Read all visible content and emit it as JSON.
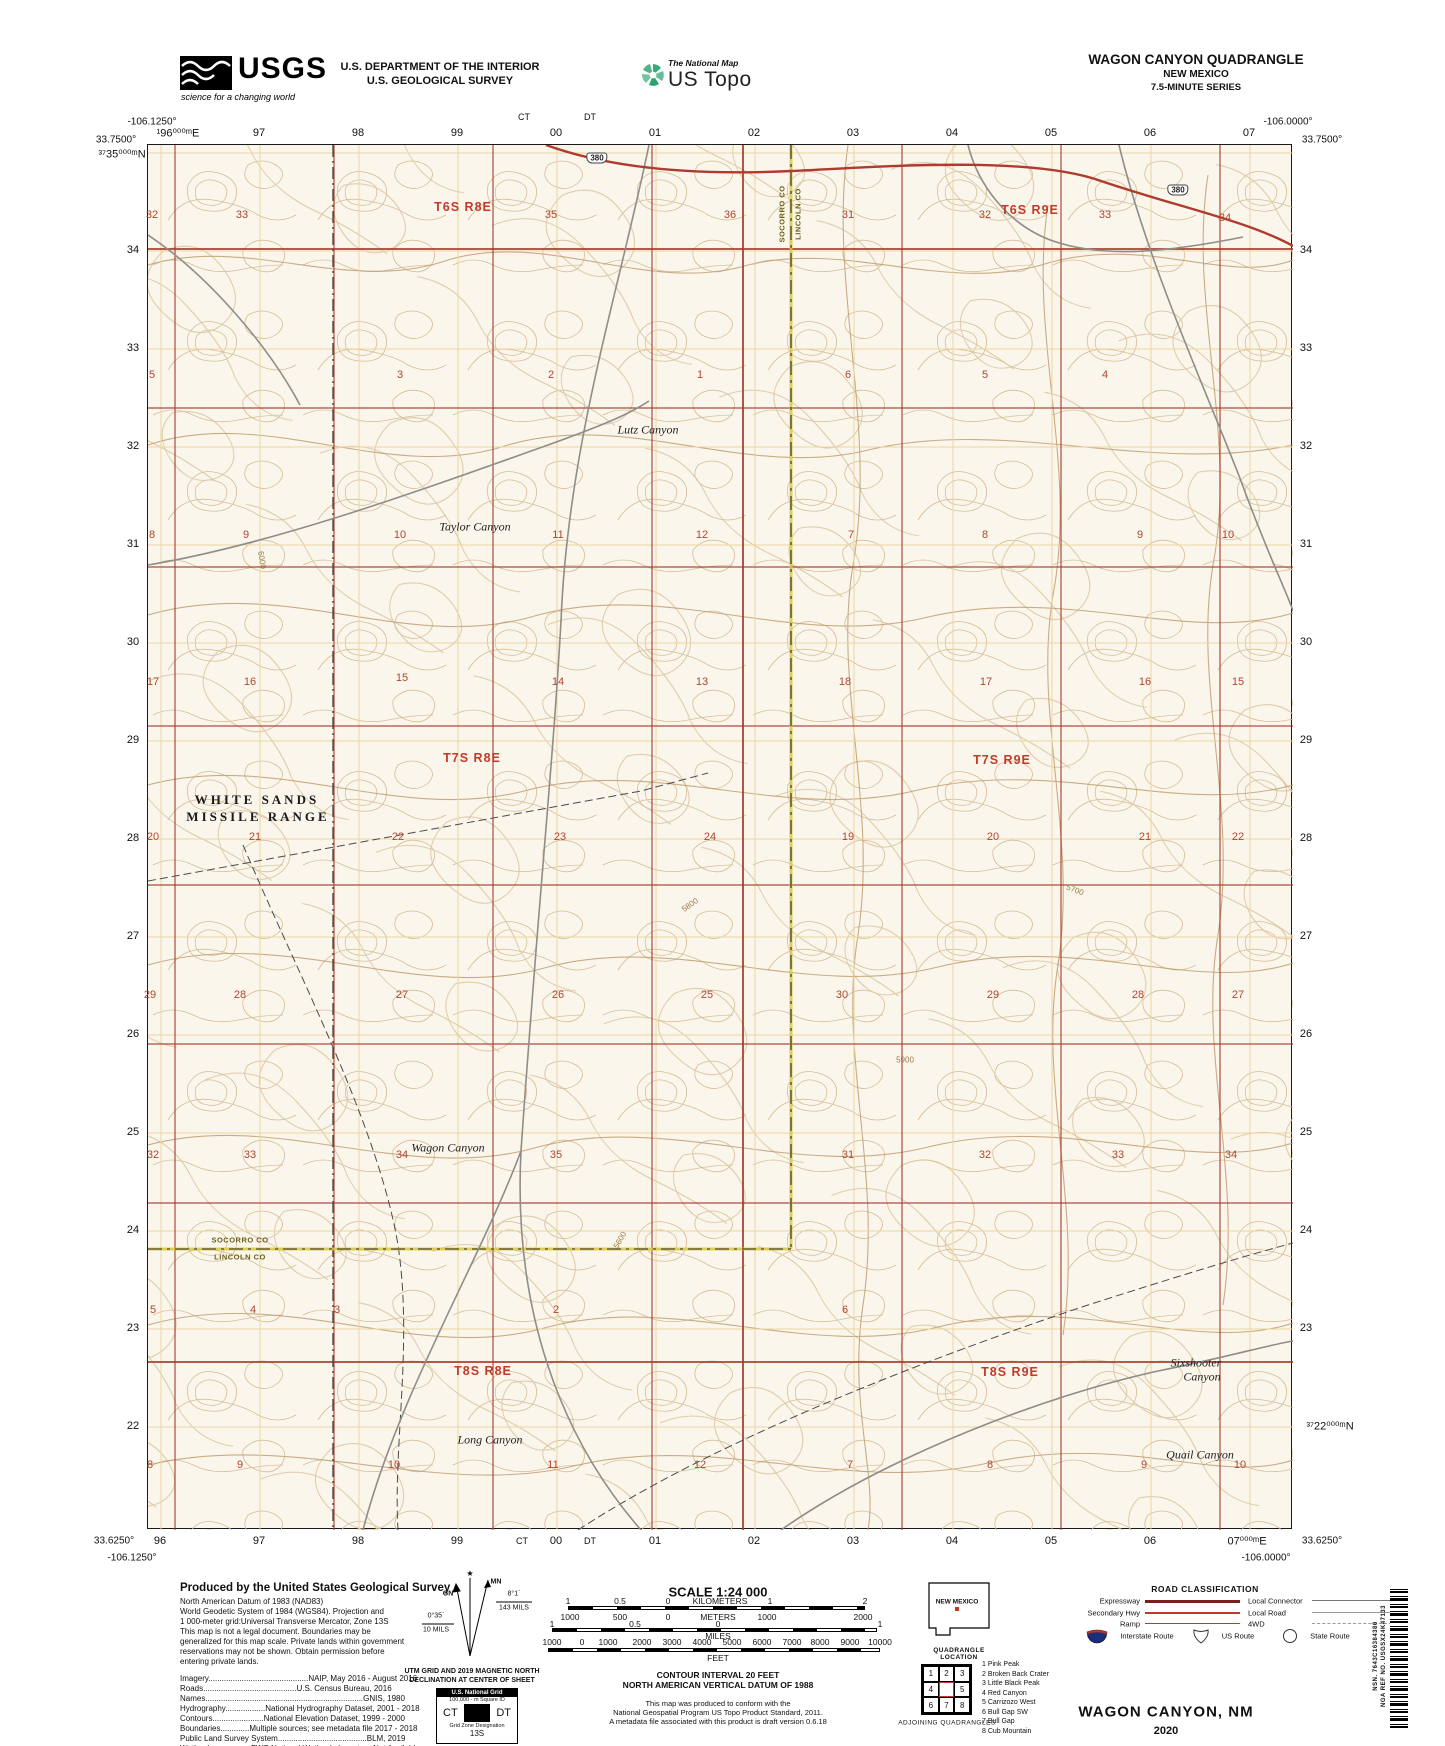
{
  "header": {
    "usgs_logo": "USGS",
    "usgs_tagline": "science for a changing world",
    "agency_line1": "U.S. DEPARTMENT OF THE INTERIOR",
    "agency_line2": "U.S. GEOLOGICAL SURVEY",
    "program_small": "The National Map",
    "program_large": "US Topo",
    "quad_title": "WAGON CANYON QUADRANGLE",
    "quad_state": "NEW MEXICO",
    "quad_series": "7.5-MINUTE SERIES"
  },
  "map": {
    "corners": {
      "tl_lon": "-106.1250°",
      "tl_lat": "33.7500°",
      "tr_lon": "-106.0000°",
      "tr_lat": "33.7500°",
      "bl_lat": "33.6250°",
      "bl_lon": "-106.1250°",
      "br_lat": "33.6250°",
      "br_lon": "-106.0000°"
    },
    "grid_cols": [
      160,
      259,
      358,
      457,
      556,
      655,
      754,
      853,
      952,
      1051,
      1150,
      1249
    ],
    "grid_rows": [
      152,
      250,
      348,
      446,
      544,
      642,
      740,
      838,
      936,
      1034,
      1132,
      1230,
      1328,
      1426
    ],
    "section_xs": [
      174,
      333,
      492,
      651,
      742,
      901,
      1060,
      1219
    ],
    "section_ys": [
      248,
      407,
      566,
      725,
      884,
      1043,
      1202,
      1361
    ],
    "top_grid": [
      {
        "t": "¹96⁰⁰⁰ᵐE",
        "x": 178,
        "y": 133
      },
      {
        "t": "97",
        "x": 259,
        "y": 133
      },
      {
        "t": "98",
        "x": 358,
        "y": 133
      },
      {
        "t": "99",
        "x": 457,
        "y": 133
      },
      {
        "t": "00",
        "x": 556,
        "y": 133
      },
      {
        "t": "01",
        "x": 655,
        "y": 133
      },
      {
        "t": "02",
        "x": 754,
        "y": 133
      },
      {
        "t": "03",
        "x": 853,
        "y": 133
      },
      {
        "t": "04",
        "x": 952,
        "y": 133
      },
      {
        "t": "05",
        "x": 1051,
        "y": 133
      },
      {
        "t": "06",
        "x": 1150,
        "y": 133
      },
      {
        "t": "07",
        "x": 1249,
        "y": 133
      },
      {
        "t": "CT",
        "x": 524,
        "y": 117
      },
      {
        "t": "DT",
        "x": 590,
        "y": 117
      }
    ],
    "bottom_grid": [
      {
        "t": "96",
        "x": 160,
        "y": 1541
      },
      {
        "t": "97",
        "x": 259,
        "y": 1541
      },
      {
        "t": "98",
        "x": 358,
        "y": 1541
      },
      {
        "t": "99",
        "x": 457,
        "y": 1541
      },
      {
        "t": "00",
        "x": 556,
        "y": 1541
      },
      {
        "t": "01",
        "x": 655,
        "y": 1541
      },
      {
        "t": "02",
        "x": 754,
        "y": 1541
      },
      {
        "t": "03",
        "x": 853,
        "y": 1541
      },
      {
        "t": "04",
        "x": 952,
        "y": 1541
      },
      {
        "t": "05",
        "x": 1051,
        "y": 1541
      },
      {
        "t": "06",
        "x": 1150,
        "y": 1541
      },
      {
        "t": "07⁰⁰⁰ᵐE",
        "x": 1247,
        "y": 1541
      },
      {
        "t": "CT",
        "x": 522,
        "y": 1541
      },
      {
        "t": "DT",
        "x": 590,
        "y": 1541
      }
    ],
    "left_grid": [
      {
        "t": "³⁷35⁰⁰⁰ᵐN",
        "x": 122,
        "y": 154
      },
      {
        "t": "34",
        "x": 133,
        "y": 250
      },
      {
        "t": "33",
        "x": 133,
        "y": 348
      },
      {
        "t": "32",
        "x": 133,
        "y": 446
      },
      {
        "t": "31",
        "x": 133,
        "y": 544
      },
      {
        "t": "30",
        "x": 133,
        "y": 642
      },
      {
        "t": "29",
        "x": 133,
        "y": 740
      },
      {
        "t": "28",
        "x": 133,
        "y": 838
      },
      {
        "t": "27",
        "x": 133,
        "y": 936
      },
      {
        "t": "26",
        "x": 133,
        "y": 1034
      },
      {
        "t": "25",
        "x": 133,
        "y": 1132
      },
      {
        "t": "24",
        "x": 133,
        "y": 1230
      },
      {
        "t": "23",
        "x": 133,
        "y": 1328
      },
      {
        "t": "22",
        "x": 133,
        "y": 1426
      }
    ],
    "right_grid": [
      {
        "t": "34",
        "x": 1306,
        "y": 250
      },
      {
        "t": "33",
        "x": 1306,
        "y": 348
      },
      {
        "t": "32",
        "x": 1306,
        "y": 446
      },
      {
        "t": "31",
        "x": 1306,
        "y": 544
      },
      {
        "t": "30",
        "x": 1306,
        "y": 642
      },
      {
        "t": "29",
        "x": 1306,
        "y": 740
      },
      {
        "t": "28",
        "x": 1306,
        "y": 838
      },
      {
        "t": "27",
        "x": 1306,
        "y": 936
      },
      {
        "t": "26",
        "x": 1306,
        "y": 1034
      },
      {
        "t": "25",
        "x": 1306,
        "y": 1132
      },
      {
        "t": "24",
        "x": 1306,
        "y": 1230
      },
      {
        "t": "23",
        "x": 1306,
        "y": 1328
      },
      {
        "t": "³⁷22⁰⁰⁰ᵐN",
        "x": 1330,
        "y": 1426
      }
    ],
    "corner_labels": [
      {
        "t": "-106.1250°",
        "x": 152,
        "y": 122
      },
      {
        "t": "33.7500°",
        "x": 116,
        "y": 140
      },
      {
        "t": "-106.0000°",
        "x": 1288,
        "y": 122
      },
      {
        "t": "33.7500°",
        "x": 1322,
        "y": 140
      },
      {
        "t": "33.6250°",
        "x": 114,
        "y": 1541
      },
      {
        "t": "-106.1250°",
        "x": 132,
        "y": 1558
      },
      {
        "t": "33.6250°",
        "x": 1322,
        "y": 1541
      },
      {
        "t": "-106.0000°",
        "x": 1266,
        "y": 1558
      }
    ],
    "townships": [
      {
        "t": "T6S R8E",
        "x": 463,
        "y": 207
      },
      {
        "t": "T6S R9E",
        "x": 1030,
        "y": 210
      },
      {
        "t": "T7S R8E",
        "x": 472,
        "y": 758
      },
      {
        "t": "T7S R9E",
        "x": 1002,
        "y": 760
      },
      {
        "t": "T8S R8E",
        "x": 483,
        "y": 1371
      },
      {
        "t": "T8S R9E",
        "x": 1010,
        "y": 1372
      }
    ],
    "sections": [
      {
        "t": "32",
        "x": 152,
        "y": 215
      },
      {
        "t": "33",
        "x": 242,
        "y": 215
      },
      {
        "t": "35",
        "x": 551,
        "y": 215
      },
      {
        "t": "36",
        "x": 730,
        "y": 215
      },
      {
        "t": "31",
        "x": 848,
        "y": 215
      },
      {
        "t": "32",
        "x": 985,
        "y": 215
      },
      {
        "t": "33",
        "x": 1105,
        "y": 215
      },
      {
        "t": "34",
        "x": 1225,
        "y": 218
      },
      {
        "t": "5",
        "x": 152,
        "y": 375
      },
      {
        "t": "3",
        "x": 400,
        "y": 375
      },
      {
        "t": "2",
        "x": 551,
        "y": 375
      },
      {
        "t": "1",
        "x": 700,
        "y": 375
      },
      {
        "t": "6",
        "x": 848,
        "y": 375
      },
      {
        "t": "5",
        "x": 985,
        "y": 375
      },
      {
        "t": "4",
        "x": 1105,
        "y": 375
      },
      {
        "t": "8",
        "x": 152,
        "y": 535
      },
      {
        "t": "9",
        "x": 246,
        "y": 535
      },
      {
        "t": "10",
        "x": 400,
        "y": 535
      },
      {
        "t": "11",
        "x": 558,
        "y": 535
      },
      {
        "t": "12",
        "x": 702,
        "y": 535
      },
      {
        "t": "7",
        "x": 851,
        "y": 535
      },
      {
        "t": "8",
        "x": 985,
        "y": 535
      },
      {
        "t": "9",
        "x": 1140,
        "y": 535
      },
      {
        "t": "10",
        "x": 1228,
        "y": 535
      },
      {
        "t": "17",
        "x": 153,
        "y": 682
      },
      {
        "t": "16",
        "x": 250,
        "y": 682
      },
      {
        "t": "15",
        "x": 402,
        "y": 678
      },
      {
        "t": "14",
        "x": 558,
        "y": 682
      },
      {
        "t": "13",
        "x": 702,
        "y": 682
      },
      {
        "t": "18",
        "x": 845,
        "y": 682
      },
      {
        "t": "17",
        "x": 986,
        "y": 682
      },
      {
        "t": "16",
        "x": 1145,
        "y": 682
      },
      {
        "t": "15",
        "x": 1238,
        "y": 682
      },
      {
        "t": "20",
        "x": 153,
        "y": 837
      },
      {
        "t": "21",
        "x": 255,
        "y": 837
      },
      {
        "t": "22",
        "x": 398,
        "y": 837
      },
      {
        "t": "23",
        "x": 560,
        "y": 837
      },
      {
        "t": "24",
        "x": 710,
        "y": 837
      },
      {
        "t": "19",
        "x": 848,
        "y": 837
      },
      {
        "t": "20",
        "x": 993,
        "y": 837
      },
      {
        "t": "21",
        "x": 1145,
        "y": 837
      },
      {
        "t": "22",
        "x": 1238,
        "y": 837
      },
      {
        "t": "29",
        "x": 150,
        "y": 995
      },
      {
        "t": "28",
        "x": 240,
        "y": 995
      },
      {
        "t": "27",
        "x": 402,
        "y": 995
      },
      {
        "t": "26",
        "x": 558,
        "y": 995
      },
      {
        "t": "25",
        "x": 707,
        "y": 995
      },
      {
        "t": "30",
        "x": 842,
        "y": 995
      },
      {
        "t": "29",
        "x": 993,
        "y": 995
      },
      {
        "t": "28",
        "x": 1138,
        "y": 995
      },
      {
        "t": "27",
        "x": 1238,
        "y": 995
      },
      {
        "t": "32",
        "x": 153,
        "y": 1155
      },
      {
        "t": "33",
        "x": 250,
        "y": 1155
      },
      {
        "t": "34",
        "x": 402,
        "y": 1155
      },
      {
        "t": "35",
        "x": 556,
        "y": 1155
      },
      {
        "t": "31",
        "x": 848,
        "y": 1155
      },
      {
        "t": "32",
        "x": 985,
        "y": 1155
      },
      {
        "t": "33",
        "x": 1118,
        "y": 1155
      },
      {
        "t": "34",
        "x": 1231,
        "y": 1155
      },
      {
        "t": "5",
        "x": 153,
        "y": 1310
      },
      {
        "t": "4",
        "x": 253,
        "y": 1310
      },
      {
        "t": "3",
        "x": 337,
        "y": 1310
      },
      {
        "t": "2",
        "x": 556,
        "y": 1310
      },
      {
        "t": "6",
        "x": 845,
        "y": 1310
      },
      {
        "t": "8",
        "x": 150,
        "y": 1465
      },
      {
        "t": "9",
        "x": 240,
        "y": 1465
      },
      {
        "t": "10",
        "x": 394,
        "y": 1465
      },
      {
        "t": "11",
        "x": 553,
        "y": 1465
      },
      {
        "t": "12",
        "x": 700,
        "y": 1465
      },
      {
        "t": "7",
        "x": 850,
        "y": 1465
      },
      {
        "t": "8",
        "x": 990,
        "y": 1465
      },
      {
        "t": "9",
        "x": 1144,
        "y": 1465
      },
      {
        "t": "10",
        "x": 1240,
        "y": 1465
      }
    ],
    "places": [
      {
        "t": "Lutz Canyon",
        "x": 648,
        "y": 430
      },
      {
        "t": "Taylor Canyon",
        "x": 475,
        "y": 527
      },
      {
        "t": "Wagon Canyon",
        "x": 448,
        "y": 1148
      },
      {
        "t": "Long Canyon",
        "x": 490,
        "y": 1440
      },
      {
        "t": "Sixshooter",
        "x": 1196,
        "y": 1363
      },
      {
        "t": "Canyon",
        "x": 1202,
        "y": 1377
      },
      {
        "t": "Quail Canyon",
        "x": 1200,
        "y": 1455
      }
    ],
    "wsmr": [
      {
        "t": "WHITE SANDS",
        "x": 257,
        "y": 800
      },
      {
        "t": "MISSILE RANGE",
        "x": 258,
        "y": 817
      }
    ],
    "county_labels": [
      {
        "t": "SOCORRO CO",
        "x": 782,
        "y": 214,
        "rot": -90
      },
      {
        "t": "LINCOLN CO",
        "x": 798,
        "y": 214,
        "rot": -90
      },
      {
        "t": "SOCORRO CO",
        "x": 240,
        "y": 1240
      },
      {
        "t": "LINCOLN CO",
        "x": 240,
        "y": 1257
      }
    ],
    "shields": [
      {
        "t": "380",
        "x": 597,
        "y": 158
      },
      {
        "t": "380",
        "x": 1178,
        "y": 190
      }
    ],
    "contour_labels": [
      {
        "t": "5800",
        "x": 690,
        "y": 905,
        "rot": -35
      },
      {
        "t": "5700",
        "x": 1075,
        "y": 890,
        "rot": 20
      },
      {
        "t": "5900",
        "x": 905,
        "y": 1060
      },
      {
        "t": "6000",
        "x": 262,
        "y": 560,
        "rot": 80
      },
      {
        "t": "5600",
        "x": 620,
        "y": 1240,
        "rot": -60
      }
    ]
  },
  "footer": {
    "produced_title": "Produced by the United States Geological Survey",
    "datum_lines": [
      "North American Datum of 1983 (NAD83)",
      "World Geodetic System of 1984 (WGS84).  Projection and",
      "1 000-meter grid:Universal Transverse Mercator, Zone 13S",
      "This map is not a legal document. Boundaries may be",
      "generalized for this map scale. Private lands within government",
      "reservations may not be shown. Obtain permission before",
      "entering private lands."
    ],
    "credit_lines": [
      "Imagery.............................................NAIP, May 2016 - August 2016",
      "Roads..........................................U.S. Census Bureau, 2016",
      "Names.......................................................................GNIS, 1980",
      "Hydrography..................National Hydrography Dataset, 2001 - 2018",
      "Contours.......................National Elevation Dataset, 1999 - 2000",
      "Boundaries.............Multiple sources; see metadata file 2017 - 2018",
      "Public Land Survey System........................................BLM, 2019",
      "Wetlands.................FWS National Wetlands Inventory Not Available"
    ],
    "declination": {
      "mn": "MN",
      "gn": "GN",
      "gn_deg": "0°35´",
      "gn_mils": "10 MILS",
      "mn_deg": "8°1´",
      "mn_mils": "143 MILS",
      "caption1": "UTM GRID AND 2019 MAGNETIC NORTH",
      "caption2": "DECLINATION AT CENTER OF SHEET"
    },
    "usng": {
      "title": "U.S. National Grid",
      "sub": "100,000 - m Square ID",
      "cell1": "CT",
      "cell2": "DT",
      "zone_label": "Grid Zone Designation",
      "zone": "13S"
    },
    "scale": {
      "title": "SCALE 1:24 000",
      "km_labels": [
        {
          "t": "1",
          "x": 568,
          "y": 1601
        },
        {
          "t": "0.5",
          "x": 620,
          "y": 1601
        },
        {
          "t": "0",
          "x": 668,
          "y": 1601
        },
        {
          "t": "KILOMETERS",
          "x": 720,
          "y": 1601
        },
        {
          "t": "1",
          "x": 770,
          "y": 1601
        },
        {
          "t": "2",
          "x": 865,
          "y": 1601
        }
      ],
      "m_labels": [
        {
          "t": "1000",
          "x": 570,
          "y": 1617
        },
        {
          "t": "500",
          "x": 620,
          "y": 1617
        },
        {
          "t": "0",
          "x": 668,
          "y": 1617
        },
        {
          "t": "METERS",
          "x": 718,
          "y": 1617
        },
        {
          "t": "1000",
          "x": 767,
          "y": 1617
        },
        {
          "t": "2000",
          "x": 863,
          "y": 1617
        }
      ],
      "mi_labels": [
        {
          "t": "1",
          "x": 552,
          "y": 1624
        },
        {
          "t": "0.5",
          "x": 635,
          "y": 1624
        },
        {
          "t": "0",
          "x": 718,
          "y": 1624
        },
        {
          "t": "1",
          "x": 880,
          "y": 1624
        }
      ],
      "miles_word": "MILES",
      "ft_labels": [
        {
          "t": "1000",
          "x": 552,
          "y": 1642
        },
        {
          "t": "0",
          "x": 582,
          "y": 1642
        },
        {
          "t": "1000",
          "x": 608,
          "y": 1642
        },
        {
          "t": "2000",
          "x": 642,
          "y": 1642
        },
        {
          "t": "3000",
          "x": 672,
          "y": 1642
        },
        {
          "t": "4000",
          "x": 702,
          "y": 1642
        },
        {
          "t": "5000",
          "x": 732,
          "y": 1642
        },
        {
          "t": "6000",
          "x": 762,
          "y": 1642
        },
        {
          "t": "7000",
          "x": 792,
          "y": 1642
        },
        {
          "t": "8000",
          "x": 820,
          "y": 1642
        },
        {
          "t": "9000",
          "x": 850,
          "y": 1642
        },
        {
          "t": "10000",
          "x": 880,
          "y": 1642
        }
      ],
      "feet_word": "FEET"
    },
    "contour_note1": "CONTOUR INTERVAL 20 FEET",
    "contour_note2": "NORTH AMERICAN VERTICAL DATUM OF 1988",
    "conformance": [
      "This map was produced to conform with the",
      "National Geospatial Program US Topo Product Standard, 2011.",
      "A metadata file associated with this product is draft version 0.6.18"
    ],
    "location": {
      "state_label": "NEW MEXICO",
      "caption": "QUADRANGLE LOCATION"
    },
    "adjoining": {
      "cells": [
        "1",
        "2",
        "3",
        "4",
        "5",
        "6",
        "7",
        "8"
      ],
      "names": [
        "1 Pink Peak",
        "2 Broken Back Crater",
        "3 Little Black Peak",
        "4 Red Canyon",
        "5 Carrizozo West",
        "6 Bull Gap SW",
        "7 Bull Gap",
        "8 Cub Mountain"
      ],
      "caption": "ADJOINING QUADRANGLES"
    },
    "road_class": {
      "title": "ROAD CLASSIFICATION",
      "left": [
        "Expressway",
        "Secondary Hwy",
        "Ramp"
      ],
      "right": [
        "Local Connector",
        "Local Road",
        "4WD"
      ],
      "interstate": "Interstate Route",
      "us_route": "US Route",
      "state_route": "State Route"
    },
    "map_title": "WAGON CANYON,  NM",
    "map_year": "2020",
    "nsn": "NSN. 7643C16384380",
    "nga": "NGA REF NO. USGSX24K47133"
  },
  "colors": {
    "contour": "#d6bd97",
    "contour_index": "#bd9a6b",
    "section_red": "#a33b2c",
    "grid_orange": "#ecd5a0",
    "county_yellow": "#d8c83c",
    "road_gray": "#8f8d88",
    "highway_red": "#b03a2e",
    "township_red": "#c23a28",
    "interstate_blue": "#1a2f7a"
  }
}
